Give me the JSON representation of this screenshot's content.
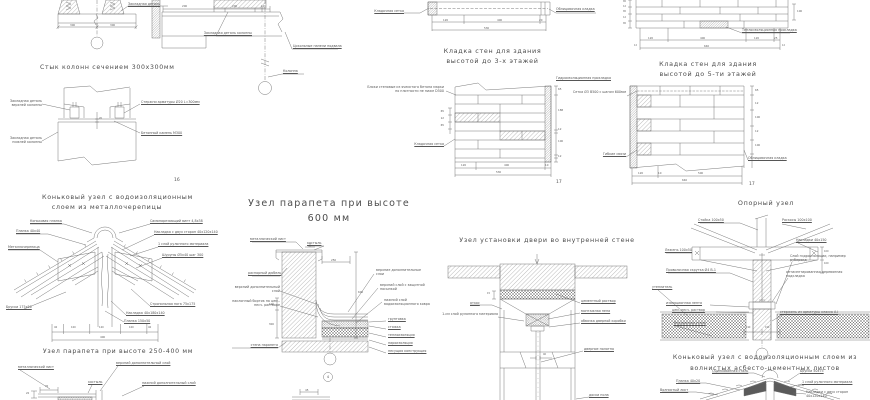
{
  "sheet": {
    "background": "#ffffff",
    "line_color": "#6a6a6a",
    "text_color": "#555555"
  },
  "column_joint": {
    "title": "Стык колонн сечением 300х300мм",
    "fig_no": "16",
    "top_detail": {
      "embed_label": "Закладная деталь",
      "dim_left": "300",
      "dim_right": "300"
    },
    "labels": {
      "upper_embed": "Закладная деталь верхней колонны",
      "lower_embed": "Закладная деталь нижней колонны",
      "bars": "Стержни арматуры Ø20 L=300мм",
      "grout": "Бетонный камень М300",
      "gap": "20"
    }
  },
  "corner_detail": {
    "dims": [
      "200",
      "200",
      "10"
    ],
    "labels": {
      "embed": "Закладная деталь колонны",
      "panels": "Цокольные панели подвала",
      "column": "Колонна"
    }
  },
  "masonry3": {
    "title_line1": "Кладка стен для здания",
    "title_line2": "высотой до 3-х этажей",
    "fig_no": "17",
    "plan": {
      "dims": [
        "120",
        "400",
        "20"
      ],
      "total": "530",
      "label_left": "Кладочная сетка",
      "label_right": "Облицовочная кладка"
    },
    "section": {
      "label_blocks": "Блоки стеновые из ячеистого бетона марки по плотности не ниже D500",
      "label_mesh": "Кладочная сетка",
      "label_right": "Гидроизоляционная прокладка",
      "right_dims": [
        "65",
        "188",
        "12",
        "100",
        "12"
      ],
      "left_dims": [
        "65",
        "12",
        "65"
      ],
      "bottom_dims": [
        "120",
        "400"
      ],
      "bottom_small": "10",
      "bottom_total": "530"
    }
  },
  "masonry5": {
    "title_line1": "Кладка стен для здания",
    "title_line2": "высотой до 5-ти этажей",
    "fig_no": "17",
    "elevation": {
      "left_dims": [
        "65",
        "12",
        "65",
        "12",
        "65"
      ],
      "right_dim": "100",
      "label": "Теплоизоляционная прокладка",
      "dims": [
        "120",
        "400",
        "120",
        "25"
      ],
      "small": "12",
      "total": "640"
    },
    "section": {
      "label_mesh": "Сетка Ø3 В500 с шагом 600мм",
      "label_ties": "Гибкие связи",
      "label_facing": "Облицовочная кладка",
      "right_dims": [
        "65",
        "12",
        "100",
        "12",
        "100"
      ],
      "bottom_dims": [
        "120",
        "500"
      ],
      "bottom_small": "10",
      "bottom_total": "640"
    }
  },
  "ridge_metal": {
    "title_line1": "Коньковый узел с водоизоляционным",
    "title_line2": "слоем из металлочерепицы",
    "labels": {
      "ridge_strip": "Коньковая планка",
      "plank": "Планка 40х40",
      "sheet": "Металлочерепица",
      "screw": "Самонарезающий винт 4,8х38",
      "overlay": "Накладка с двух сторон 40х120х140",
      "layer": "1 слой рулонного материала",
      "screws": "Шурупы Ø5х40 шаг 300",
      "bars": "Бруски 175х50",
      "rafter": "Стропильная нога 75х175",
      "plate": "Накладка 40х180х140",
      "plank2": "Планка 150х50"
    },
    "dims": [
      "40",
      "100",
      "120",
      "100",
      "40"
    ],
    "total": "400"
  },
  "parapet250": {
    "title": "Узел парапета при высоте 250-400 мм",
    "labels": {
      "sheet": "металлический лист",
      "upper": "верхний дополнительный слой",
      "lower": "нижний дополнительный слой",
      "spike": "костыль"
    },
    "dims": [
      "70",
      "20"
    ]
  },
  "parapet600": {
    "title_line1": "Узел парапета при высоте",
    "title_line2": "600 мм",
    "callout": "4",
    "labels": {
      "sheet": "металлический лист",
      "spike": "костыль",
      "dowel": "распорный дюбель",
      "upper_add": "верхний дополнительный слой",
      "bead": "наклонный бортик на цем.-песч. растворе",
      "wall": "стена парапета",
      "right_add": "верхние дополнительные слои",
      "top_layer": "верхний слой с защитной посыпкой",
      "bottom_layer": "нижний слой водоизоляционного ковра",
      "primer": "грунтовка",
      "screed": "стяжка",
      "insulation": "теплоизоляция",
      "vapor": "пароизоляция",
      "bearing": "несущая конструкция"
    },
    "dims": {
      "cap": "250",
      "height": "600",
      "left1": "100",
      "left2": "300",
      "bottom": "45"
    }
  },
  "door_node": {
    "title": "Узел установки двери во внутренней стене",
    "labels": {
      "slope": "откос",
      "roll": "1-см слой рулонного материала",
      "cement": "цементный раствор",
      "foam": "монтажная пена",
      "frame": "обвязка дверной коробки",
      "leaf": "дверное полотно",
      "floor": "доски пола"
    },
    "dims": {
      "reveal": "15",
      "leaf": "40"
    }
  },
  "support_node": {
    "title": "Опорный узел",
    "labels": {
      "post": "Стойка 100х50",
      "braces": "Раскосы 100х100",
      "plates": "Накладки 40х150",
      "sill": "Лежень 100х50",
      "twist": "Проволочная скрутка Ø4 В-1",
      "hydro": "Слой гидроизоляции, например рубероид",
      "pad": "антисептированная деревянная подкладка",
      "insulation": "утеплитель",
      "tape": "изоляционная лента",
      "mortar": "цем.-песч. раствор",
      "wall": "Внутренняя стена",
      "rod": "стержень из арматуры класса А-I"
    },
    "dims": {
      "right": [
        "100",
        "100"
      ],
      "base": [
        "190",
        "190"
      ]
    }
  },
  "ridge_asbestos": {
    "title_line1": "Коньковый узел с водоизоляционным слоем из",
    "title_line2": "волнистых асбесто-цементных листов",
    "labels": {
      "steel": "Оцинкованная сталь",
      "bars": "Бруски 50х75",
      "plank": "Планка 40х20",
      "sheet": "Волнистый лист",
      "layer": "1 слой рулонного материала",
      "overlay": "Накладки с двух сторон 40х120х140"
    }
  }
}
